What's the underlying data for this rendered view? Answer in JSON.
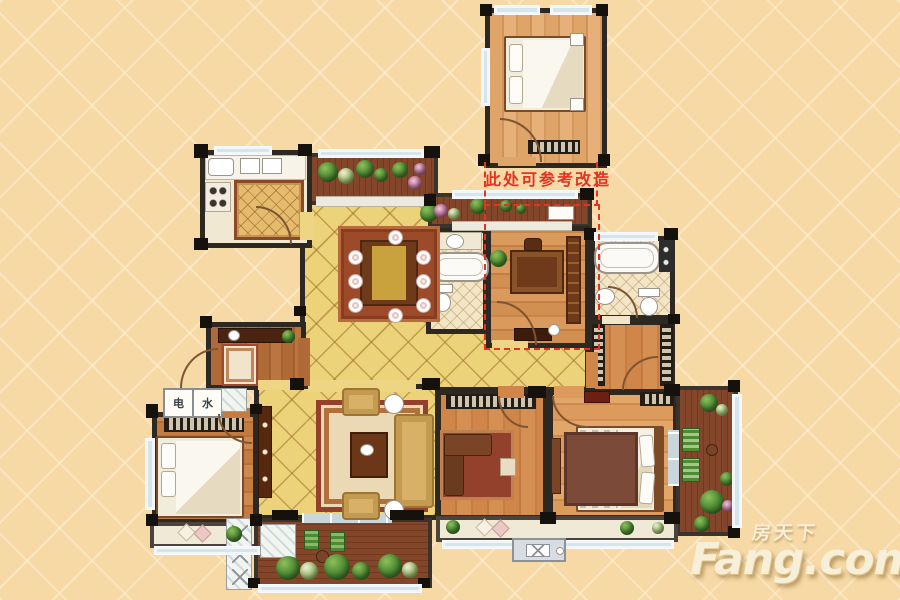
{
  "annotation": {
    "text": "此处可参考改造",
    "color": "#e13422"
  },
  "utility": {
    "electric": "电",
    "water": "水"
  },
  "watermark": {
    "cn": "房天下",
    "en": "Fang.com"
  },
  "colors": {
    "background": "#f7d9a6",
    "wall": "#2e2822",
    "tile_floor": "#ecd279",
    "wood_floor": "#d2894d",
    "balcony_deck": "#84462a",
    "annotation_red": "#e13422",
    "window": "#d6e4ec",
    "watermark_text": "#f8efd8"
  }
}
